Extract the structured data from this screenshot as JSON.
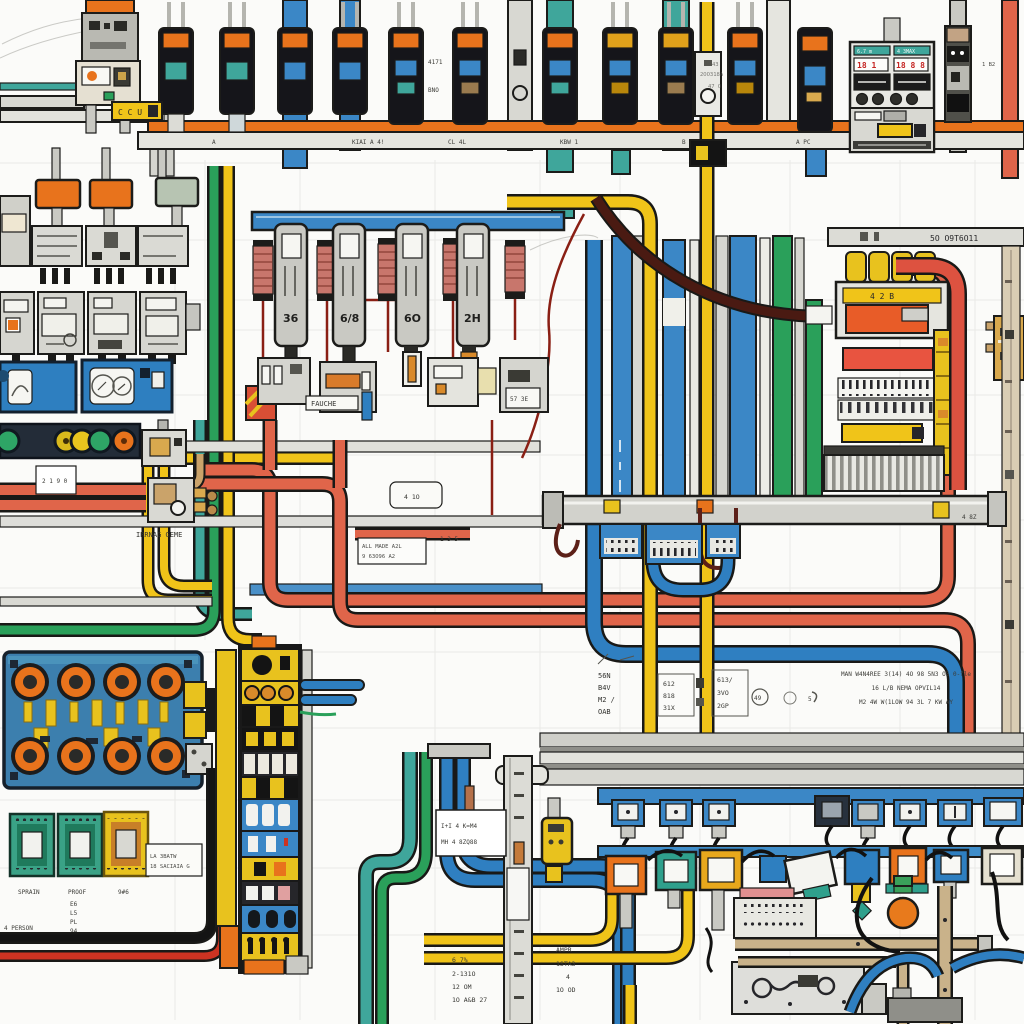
{
  "palette": {
    "orange": "#e8731c",
    "amber": "#e0a11b",
    "yellow": "#f0c419",
    "yellow_block": "#e8c21e",
    "blue_wire": "#2f7fc1",
    "blue_rail": "#3b87c6",
    "teal": "#3fa69b",
    "green": "#2aa05a",
    "salmon": "#e0654a",
    "red_block": "#e85440",
    "maroon": "#5c2018",
    "thin_red": "#8a1f14",
    "pink_module": "#c8766c",
    "navy": "#232c38",
    "board_blue": "#3c7fae",
    "tan": "#c9b28a",
    "gold": "#d9a94e",
    "gray_light": "#dcdcd6",
    "cream": "#efece2",
    "black_wire": "#141414"
  },
  "top": {
    "ccu_tag": "C C U",
    "note_a1": "4171",
    "note_a2": "BNO",
    "note_b1": "43",
    "note_b2": "2OO318A",
    "note_b3": "47 O",
    "bus_marks": [
      "A",
      "KIAI A 4!",
      "CL 4L",
      "KBW 1",
      "B M4",
      "A PC"
    ],
    "strip_mark": "1 B2",
    "control": {
      "hdr_l": "6.7 m",
      "hdr_r": "4 3MAX",
      "dig_l": "18 1",
      "dig_r": "18 8 8"
    }
  },
  "left": {
    "note": "IRRNAG GEME",
    "mini_box": "2 1 9 0"
  },
  "middle": {
    "module_labels": [
      "36",
      "6/8",
      "6O",
      "2H"
    ],
    "fuse_tag": "FAUCHE",
    "base_label": "57 3E",
    "wire_tag": "1 3 5",
    "white_box_l1": "ALL MADE A2L",
    "white_box_l2": "9 63O96 A2",
    "small_box": "4 1O"
  },
  "right": {
    "bus_text": "5O O9T6O11",
    "panel_label": "4 2 B",
    "bus_tag": "4 8Z"
  },
  "annotations": {
    "a": [
      "56N",
      "B4V",
      "M2 /",
      "OAB"
    ],
    "b": [
      "612",
      "818",
      "31X"
    ],
    "c": [
      "613/",
      "3VO",
      "2GP"
    ],
    "circle1": "49",
    "circle2": "5",
    "right_lines": [
      "MAN W4N4REE 3(14) 4O 98 5N3 O5 0-fle",
      "16 L/B  NEMA OPVIL14",
      "M2 4W W(1LOW  94 3L 7 KW AY"
    ],
    "mid_a": [
      "6 7%",
      "2-131O",
      "12 OM",
      "1O A&B 27"
    ],
    "mid_b": [
      "AMPR",
      "1STA3",
      "4",
      "1O OD"
    ],
    "tick_box_l1": "I+I 4 K=M4",
    "tick_box_l2": "MH 4 8ZQ88"
  },
  "bottom_left": {
    "chip_labels": [
      "SPRAIN",
      "PROOF",
      "9#6"
    ],
    "col": [
      "E6",
      "L5",
      "PL",
      "94"
    ],
    "person": "4 PERSON",
    "label_box": [
      "LA 3BATW",
      "18 SACIAIA G"
    ]
  }
}
